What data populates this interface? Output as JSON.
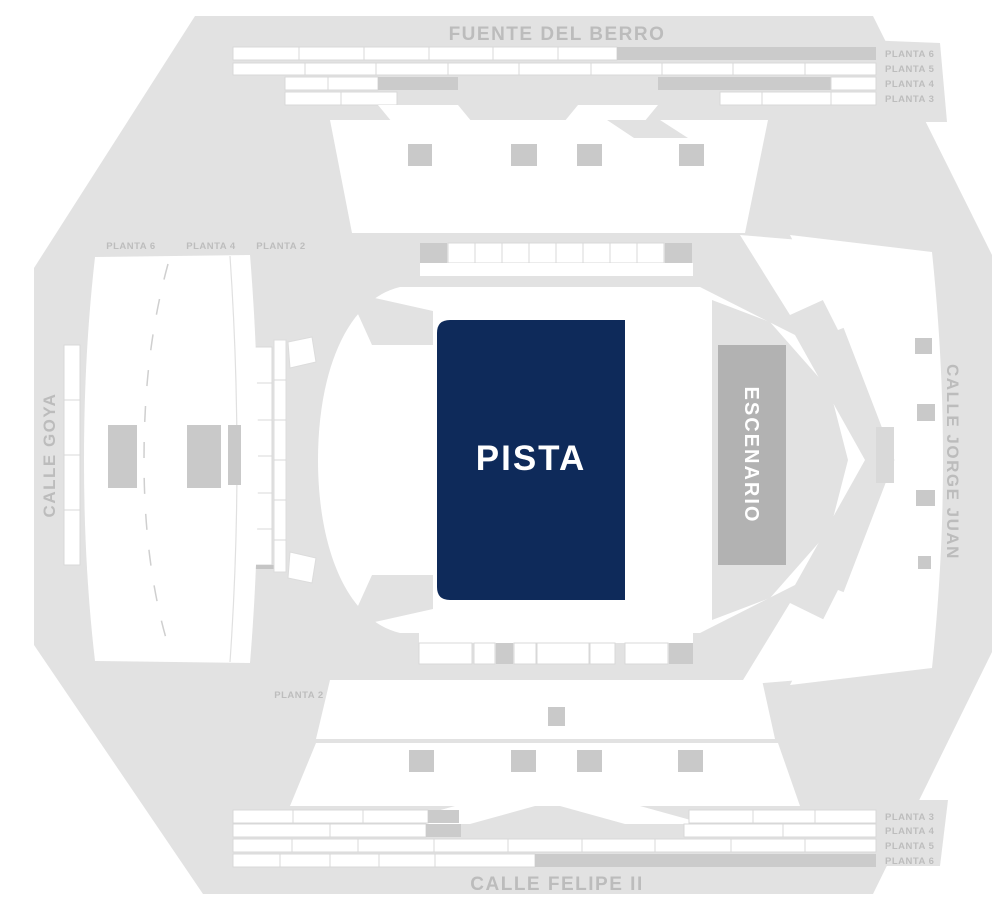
{
  "venue_map": {
    "streets": {
      "top": "FUENTE DEL BERRO",
      "bottom": "CALLE FELIPE II",
      "left": "CALLE GOYA",
      "right": "CALLE JORGE JUAN"
    },
    "zones": {
      "pista_label": "PISTA",
      "escenario_label": "ESCENARIO"
    },
    "level_labels": {
      "top_right": [
        "PLANTA 6",
        "PLANTA 5",
        "PLANTA 4",
        "PLANTA 3"
      ],
      "bottom_right": [
        "PLANTA 3",
        "PLANTA 4",
        "PLANTA 5",
        "PLANTA 6"
      ],
      "west": [
        "PLANTA 6",
        "PLANTA 4",
        "PLANTA 2"
      ],
      "south": [
        "PLANTA 2"
      ]
    },
    "colors": {
      "pista": "#0e2a5a",
      "stage_block": "#b2b2b2",
      "silhouette": "#e2e2e2",
      "filled_cell": "#cbcbcb",
      "label_text": "#bdbdbd",
      "street_text": "#bcbcbc"
    }
  }
}
